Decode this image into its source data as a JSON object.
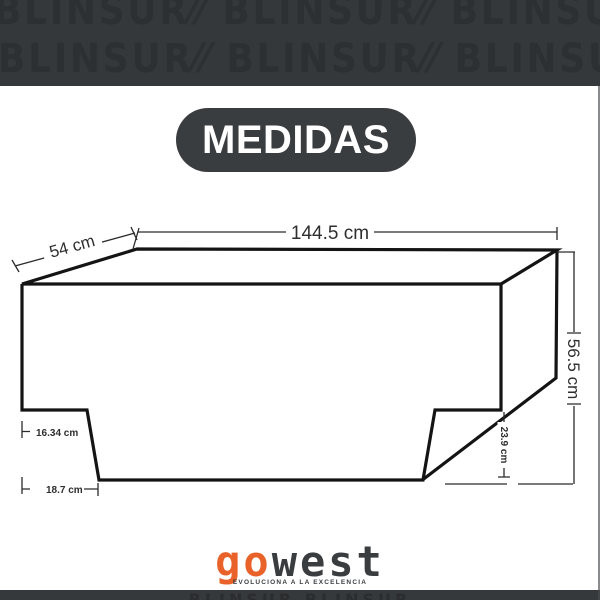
{
  "banner": {
    "watermark_row1": "BLINSUR⁄⁄ BLINSUR⁄⁄ BLINSUR⁄⁄ BLINSUR⁄⁄",
    "watermark_row2": "BLINSUR⁄⁄ BLINSUR⁄⁄ BLINSUR⁄⁄ BLINSUR⁄⁄"
  },
  "title_pill": {
    "label": "MEDIDAS"
  },
  "diagram": {
    "measurements": {
      "top_width": "144.5 cm",
      "side_depth": "54 cm",
      "total_height": "56.5 cm",
      "notch_height": "23.9 cm",
      "left_upper_inset": "16.34 cm",
      "left_lower_inset": "18.7 cm"
    }
  },
  "footer": {
    "logo_primary": "go",
    "logo_secondary": "west",
    "tagline": "EVOLUCIONA A LA EXCELENCIA",
    "bar_watermark": "BLINSUR BLINSUR"
  },
  "colors": {
    "accent_orange": "#e8622a",
    "charcoal": "#35383a",
    "line_black": "#141414"
  }
}
